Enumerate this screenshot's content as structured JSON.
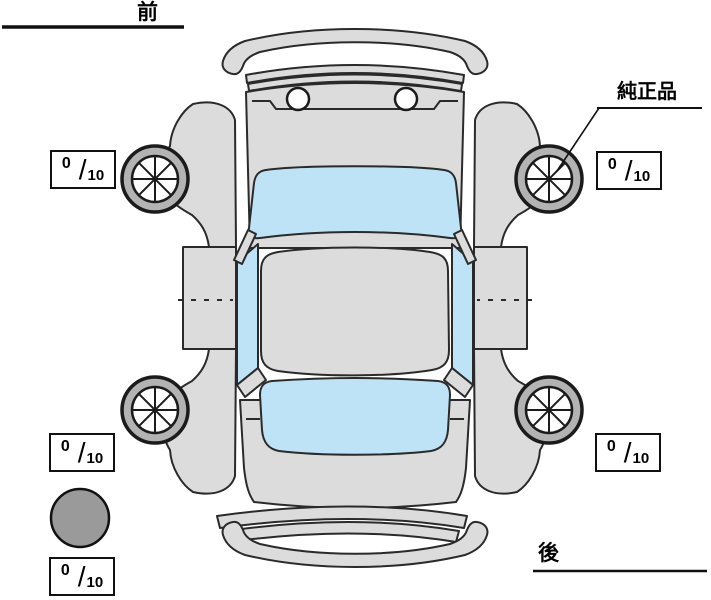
{
  "diagram": {
    "front_label": "前",
    "rear_label": "後",
    "genuine_parts_label": "純正品",
    "colors": {
      "background": "#ffffff",
      "body": "#dcdcdc",
      "glass": "#bee3f6",
      "tire_ring": "#b3b3b3",
      "spare": "#9a9a9a",
      "line": "#2a2a2a",
      "box_border": "#111111"
    }
  },
  "tires": {
    "separator": "/",
    "front_left": {
      "tread": "0",
      "max": "10"
    },
    "front_right": {
      "tread": "0",
      "max": "10"
    },
    "rear_left": {
      "tread": "0",
      "max": "10"
    },
    "rear_right": {
      "tread": "0",
      "max": "10"
    },
    "spare": {
      "tread": "0",
      "max": "10"
    }
  }
}
